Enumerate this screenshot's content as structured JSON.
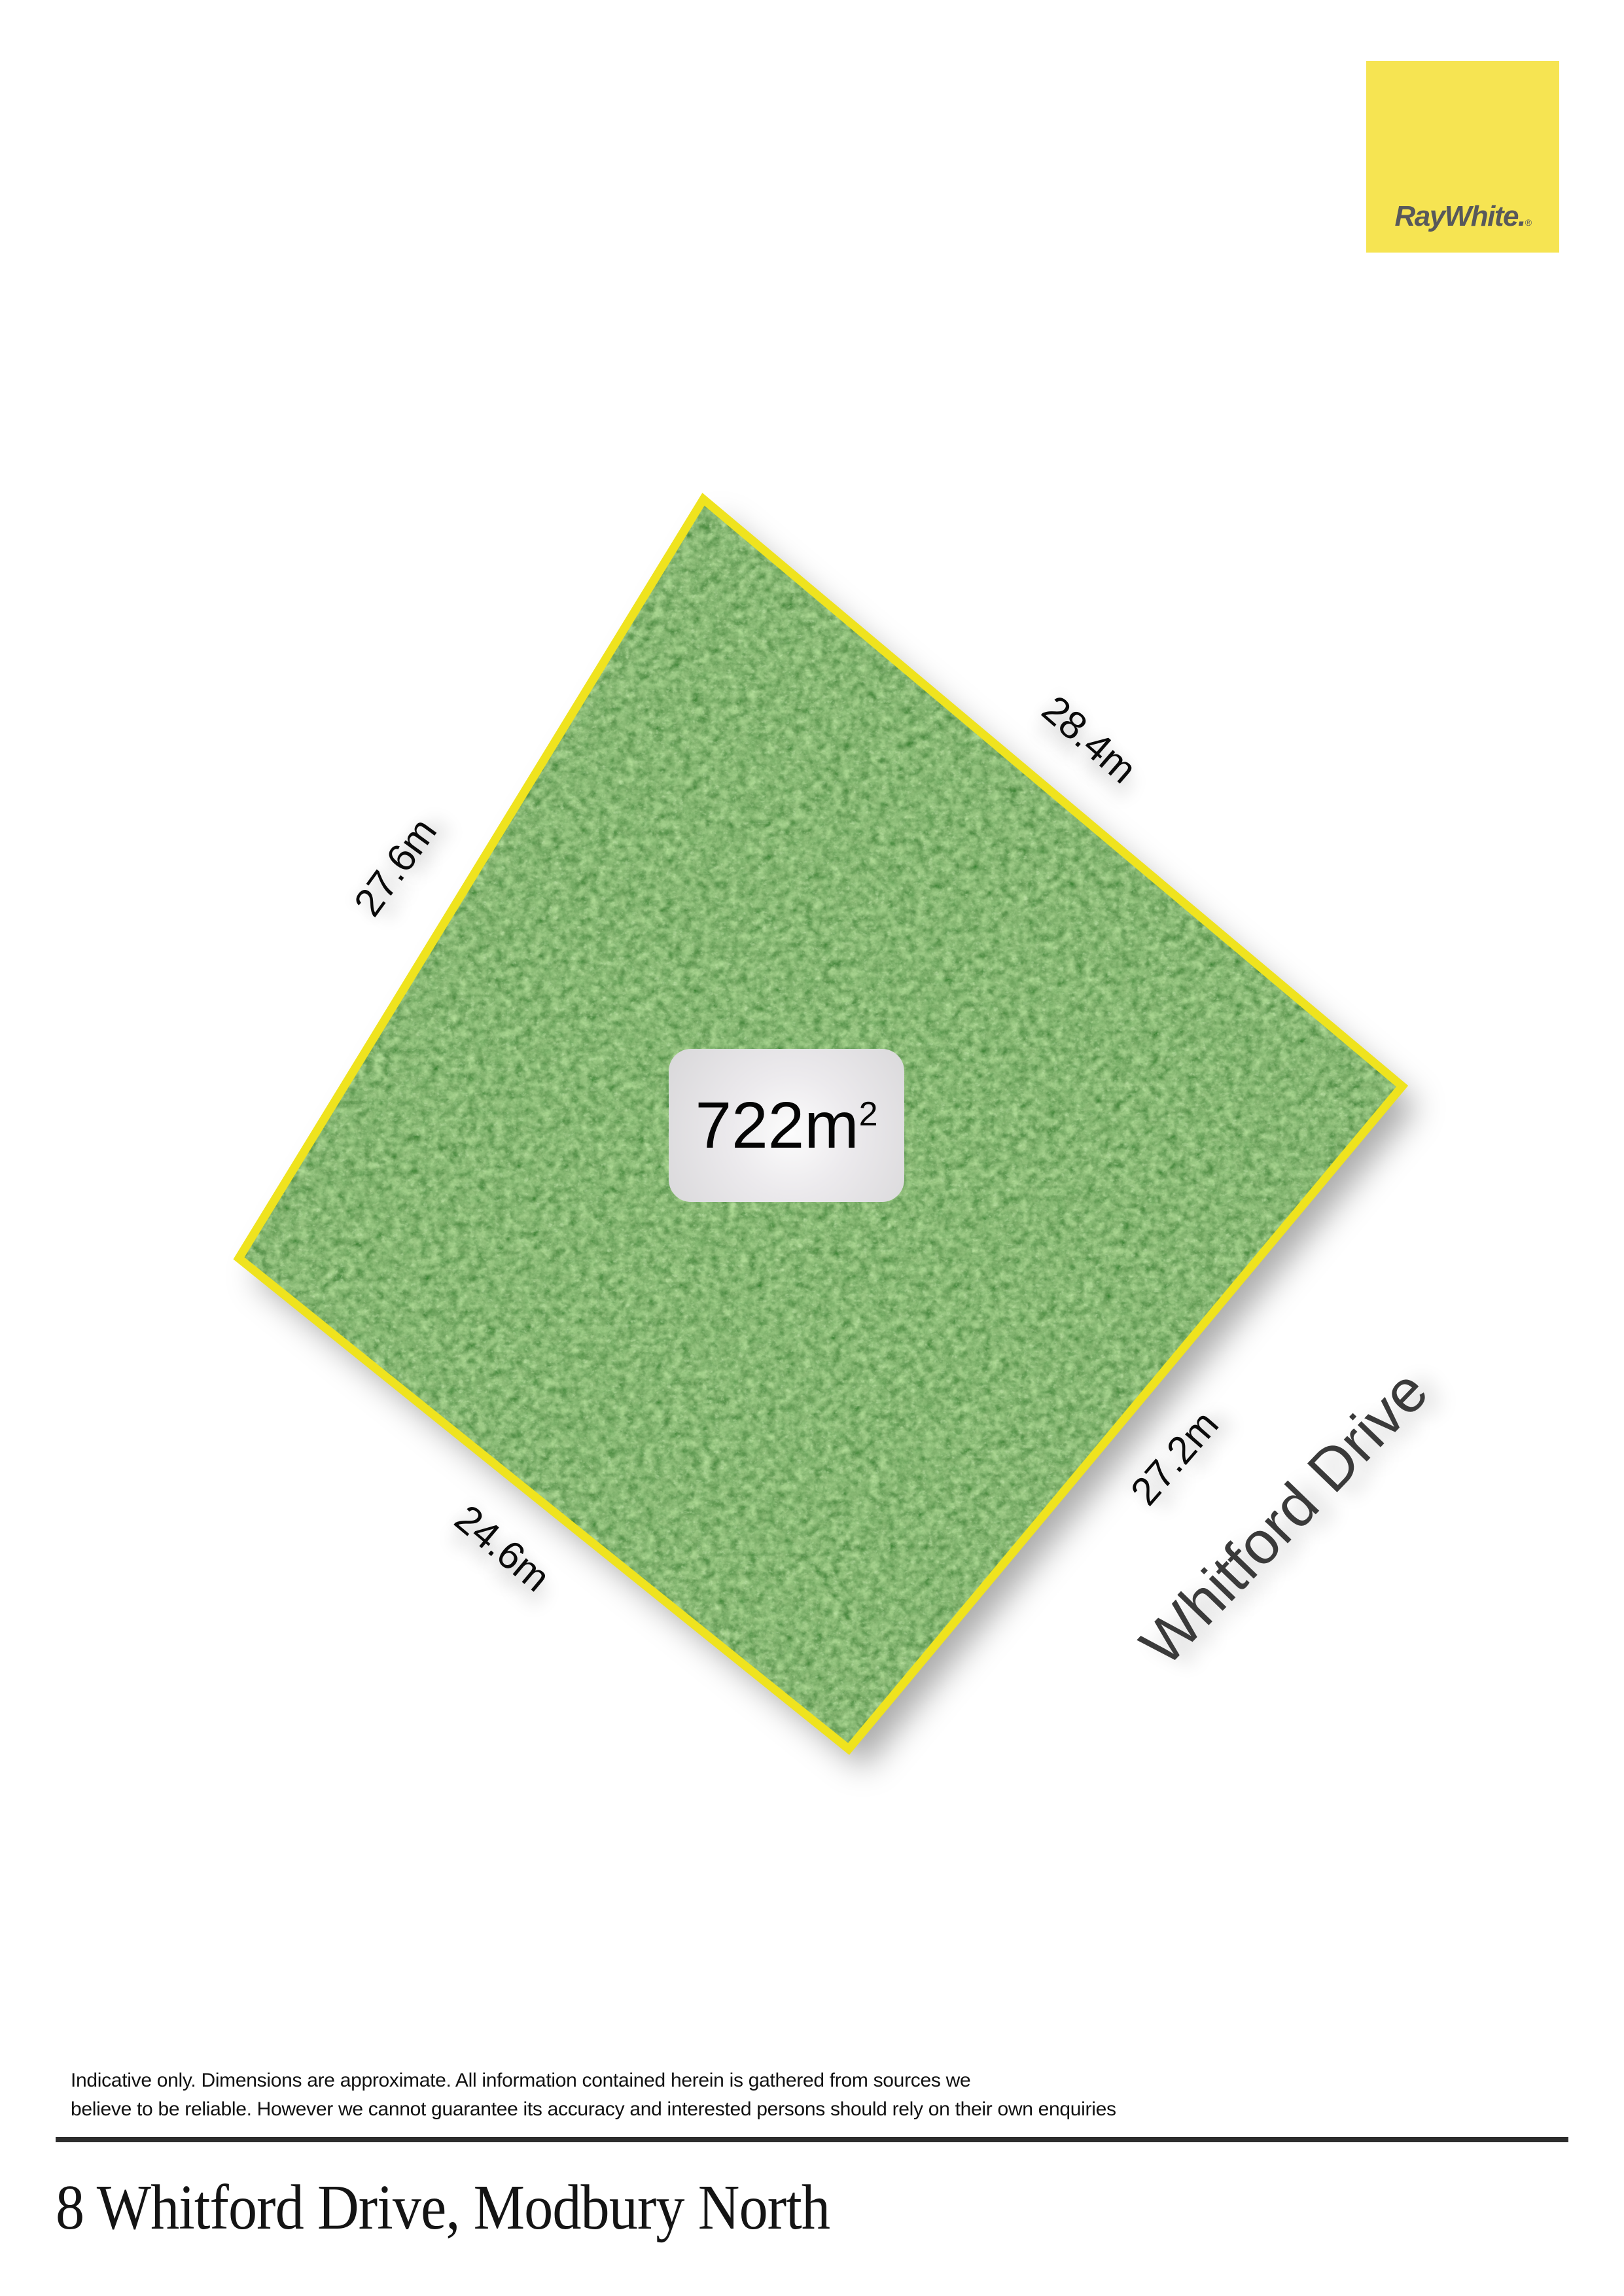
{
  "logo": {
    "brand": "RayWhite.",
    "registered": "®",
    "bg_color": "#F6E452",
    "text_color": "#58595B"
  },
  "plot": {
    "area_value": "722m",
    "area_superscript": "2",
    "border_color": "#EFE31E",
    "dimensions": {
      "top_right": "28.4m",
      "top_left": "27.6m",
      "bottom_right": "27.2m",
      "bottom_left": "24.6m"
    },
    "street_label": "Whitford Drive"
  },
  "footer": {
    "disclaimer_line1": "Indicative only. Dimensions are approximate. All information contained herein is gathered from sources we",
    "disclaimer_line2": "believe to be reliable. However we cannot guarantee its accuracy and interested persons should rely on their own enquiries",
    "address": "8 Whitford Drive, Modbury North"
  }
}
